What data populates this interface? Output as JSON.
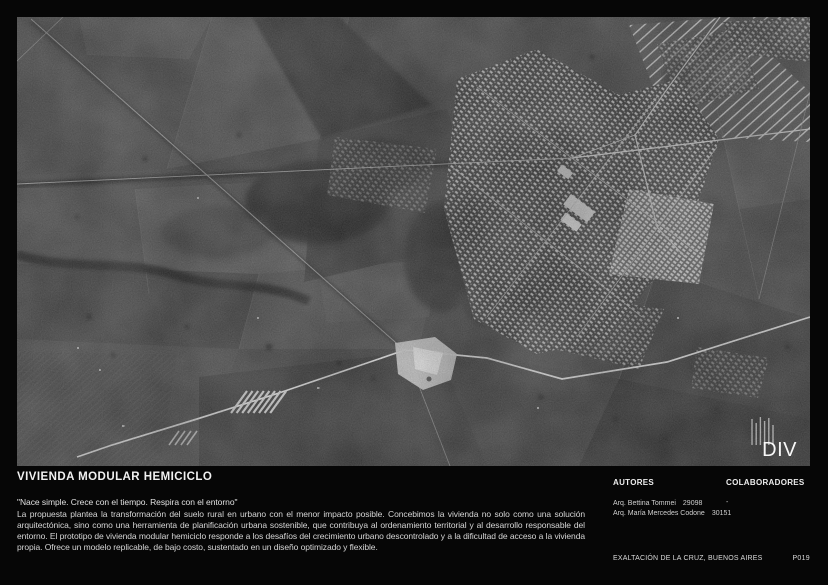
{
  "board": {
    "title": "VIVIENDA MODULAR HEMICICLO",
    "quote": "\"Nace simple. Crece con el tiempo. Respira con el entorno\"",
    "description": "La propuesta plantea la transformación del suelo rural en urbano con el menor impacto posible. Concebimos la vivienda no solo como una solución arquitectónica, sino como una herramienta de planificación urbana sostenible, que contribuya al ordenamiento territorial y al desarrollo responsable del entorno. El prototipo de vivienda modular hemiciclo responde a los desafíos del crecimiento urbano descontrolado y a la dificultad de acceso a la vivienda propia. Ofrece un modelo replicable, de bajo costo, sustentado en un diseño optimizado y flexible."
  },
  "map": {
    "watermark": "DIV",
    "image_description": "black-and-white aerial photograph of Exaltación de la Cruz: rural fields, tree lines, diagonal roads and a dense town grid"
  },
  "credits": {
    "autores": {
      "heading": "AUTORES",
      "entries": [
        {
          "name": "Arq. Bettina Tommei",
          "id": "29098"
        },
        {
          "name": "Arq. María Mercedes Codone",
          "id": "30151"
        }
      ]
    },
    "colaboradores": {
      "heading": "COLABORADORES",
      "value": "-"
    }
  },
  "footer": {
    "location": "EXALTACIÓN DE LA CRUZ, BUENOS AIRES",
    "page": "P019"
  },
  "colors": {
    "background": "#060606",
    "text": "#d6d6d6",
    "photo_base": "#4a4a4a"
  }
}
